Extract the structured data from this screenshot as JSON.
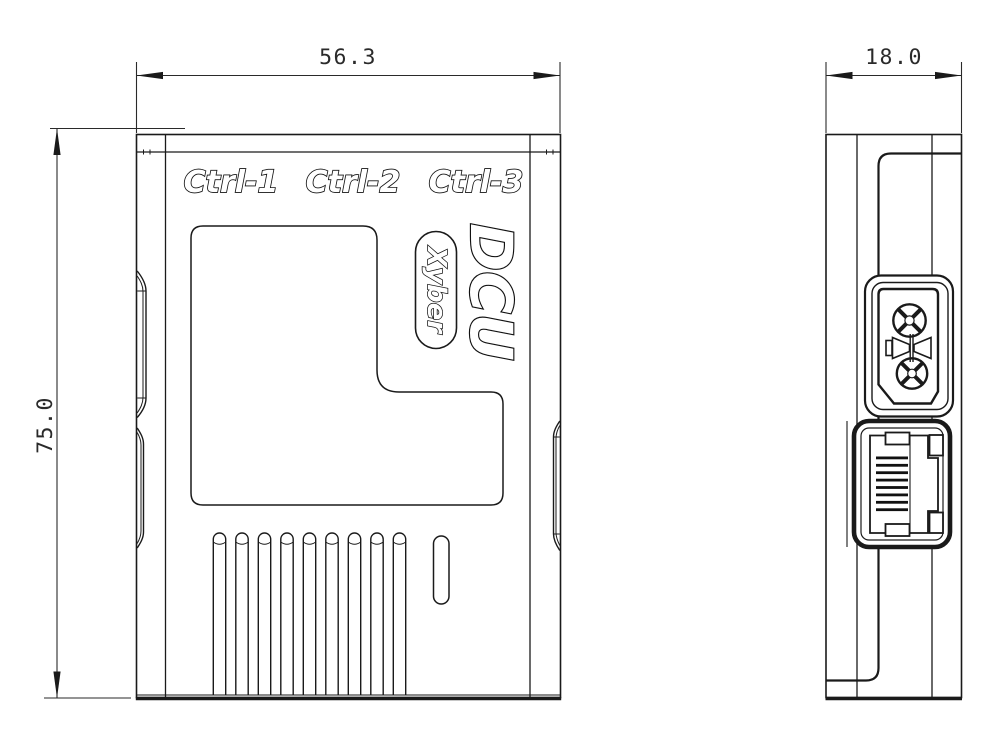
{
  "dimensions": {
    "front_width_mm": "56.3",
    "front_height_mm": "75.0",
    "side_depth_mm": "18.0"
  },
  "front_view": {
    "port_labels": [
      "Ctrl-1",
      "Ctrl-2",
      "Ctrl-3"
    ],
    "product_name": "DCU",
    "brand": "Xyber"
  },
  "colors": {
    "line": "#1a1a1a",
    "background": "#ffffff"
  }
}
